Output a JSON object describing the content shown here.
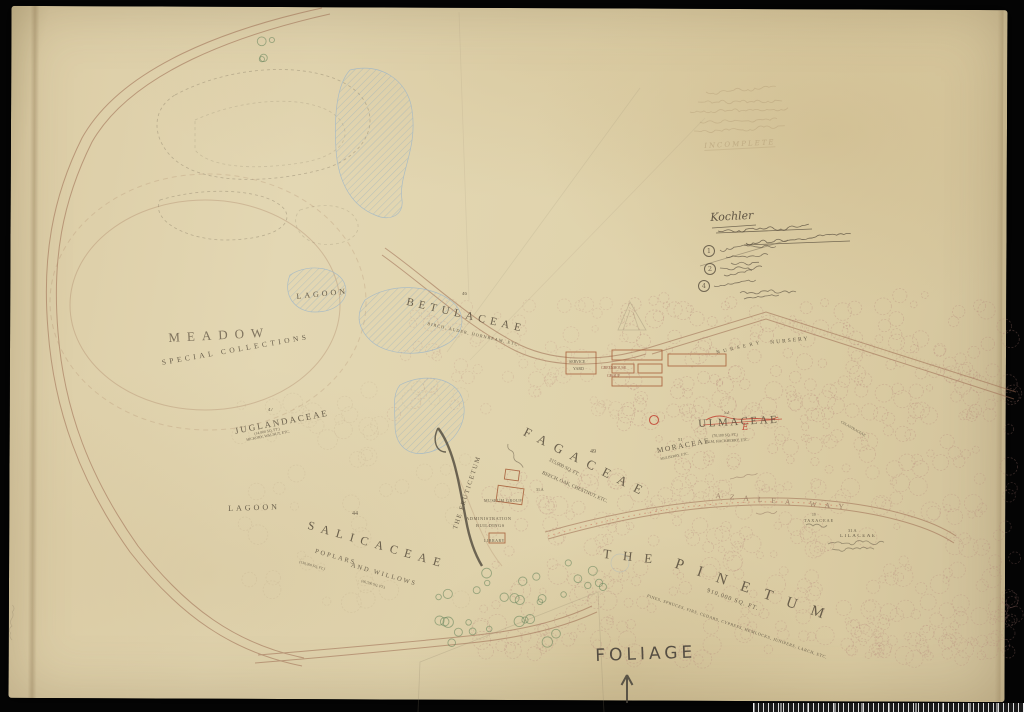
{
  "labels": {
    "meadow": "MEADOW",
    "special_collections": "SPECIAL COLLECTIONS",
    "lagoon_upper": "LAGOON",
    "lagoon_lower": "LAGOON",
    "betulaceae": {
      "num": "46",
      "name": "BETULACEAE",
      "sub": "BIRCH, ALDER, HORNBEAM, ETC."
    },
    "juglandaceae": {
      "num": "47",
      "name": "JUGLANDACEAE",
      "area": "(14,800 SQ. FT.)",
      "sub": "HICKORY, WALNUT, ETC."
    },
    "salicaceae": {
      "num": "44",
      "name": "SALICACEAE",
      "sub1": "POPLARS",
      "sub2": "AND WILLOWS",
      "area1": "(130,300 SQ. FT.)",
      "area2": "(66,700 SQ. FT.)"
    },
    "fagaceae": {
      "num": "49",
      "name": "FAGACEAE",
      "area": "315,000 SQ. FT.",
      "sub": "BEECH, OAK, CHESTNUT, ETC.",
      "plot": "31 A"
    },
    "ulmaceae": {
      "num": "52",
      "name": "ULMACEAE",
      "area": "(70,100 SQ. FT.)",
      "sub": "ELM, HACKBERRY, ETC.",
      "red_mark": "E"
    },
    "moraceae": {
      "num": "51",
      "name": "MORACEAE",
      "sub": "MULBERRY, ETC."
    },
    "pinetum": {
      "the": "THE",
      "name": "PINETUM",
      "area": "910,000 SQ. FT.",
      "sub": "PINES, SPRUCES, FIRS, CEDARS, CYPRESS, HEMLOCKS, JUNIPERS, LARCH, ETC."
    },
    "azalea_way": "AZALEA WAY",
    "lilaceae": {
      "num": "31 A",
      "name": "LILACEAE"
    },
    "taxaceae": {
      "num": "19",
      "name": "TAXACEAE"
    },
    "celastraceae": "CELASTRACEAE",
    "fruticetum": "THE FRUTICETUM",
    "museum_group": "MUSEUM GROUP",
    "administration_1": "ADMINISTRATION",
    "administration_2": "BUILDINGS",
    "library": "LIBRARY",
    "service_yard_1": "SERVICE",
    "service_yard_2": "YARD",
    "greenhouse_1": "GREENHOUSE",
    "greenhouse_2": "GROUP",
    "nursery_curved": "NURSERY",
    "nursery_right": "NURSERY"
  },
  "annotations": {
    "foliage": "FOLIAGE",
    "note_heading": "Kochler",
    "incomplete": "INCOMPLETE",
    "circled_1": "1",
    "circled_2": "2",
    "circled_4": "4"
  },
  "colors": {
    "paper": "#e0d3ac",
    "ink": "#564c3c",
    "road_brown": "#9b6a50",
    "tree_red": "#b5837a",
    "water_blue": "#87a9c4",
    "accent_red": "#c0392b",
    "pencil": "#8a7e68",
    "green": "#5f7f57"
  }
}
